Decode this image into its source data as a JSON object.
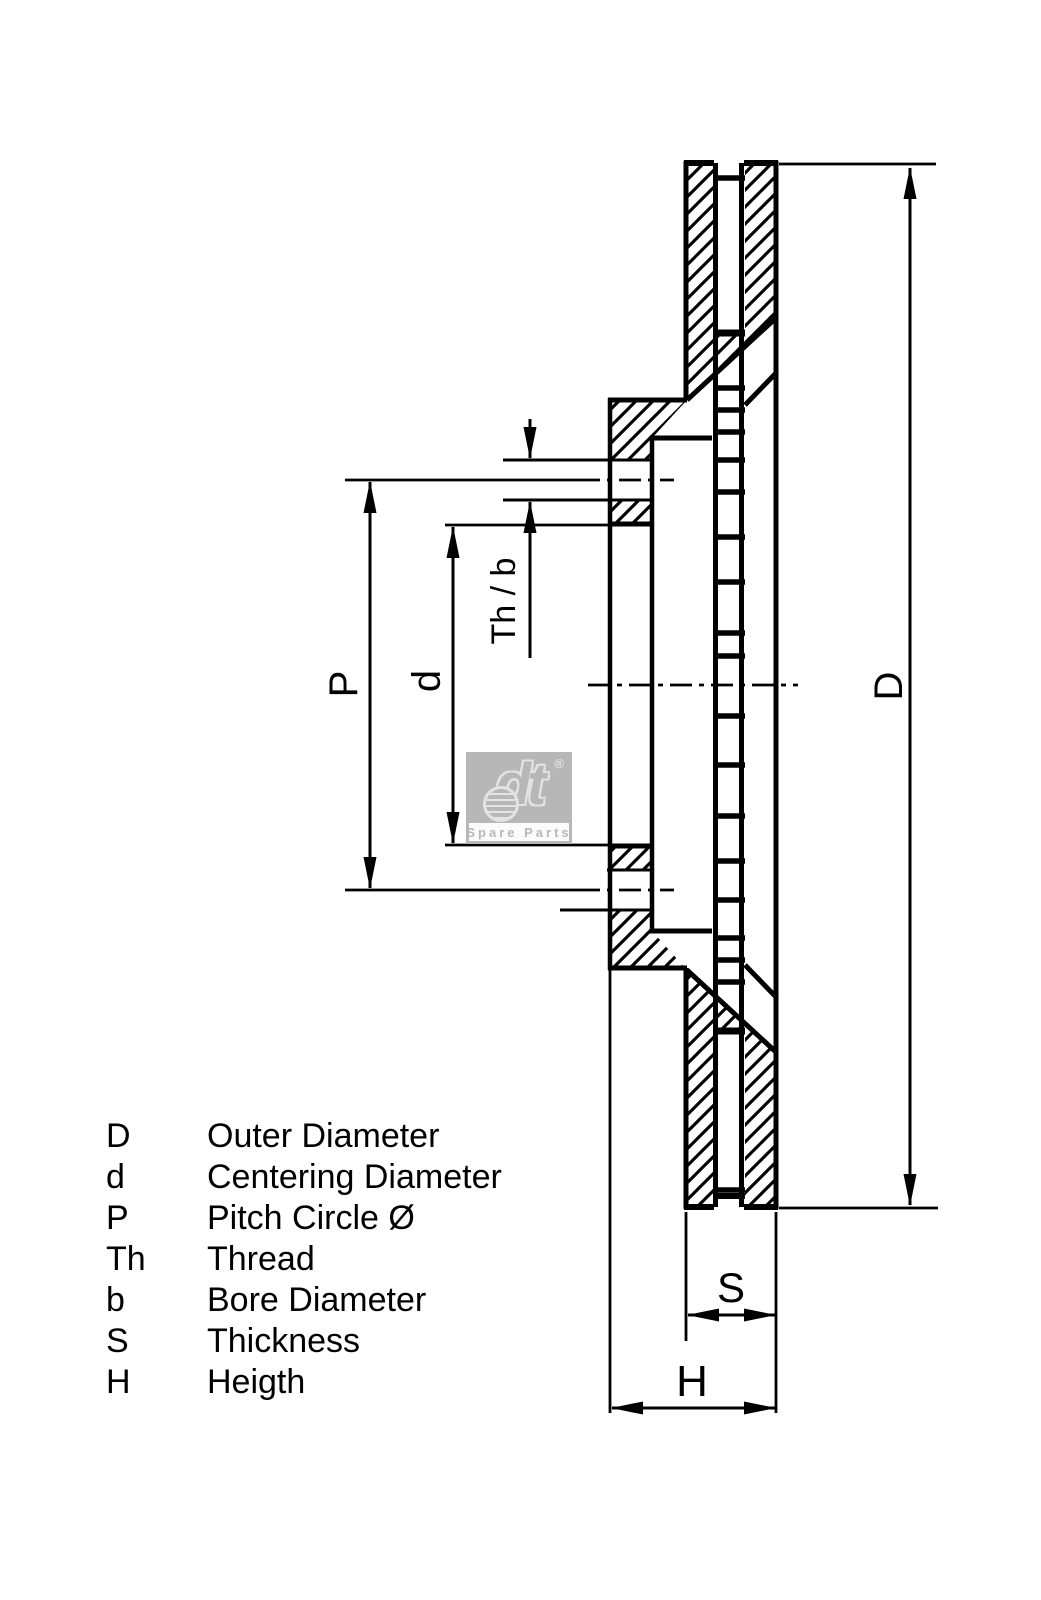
{
  "drawing": {
    "type": "ventilated-brake-disc-cross-section",
    "line_color": "#000000",
    "background_color": "#ffffff"
  },
  "watermark": {
    "brand": "dt",
    "registered": "®",
    "tagline": "Spare Parts",
    "box_color": "#b7b7b7"
  },
  "dimension_labels": {
    "pitch_circle": "P",
    "centering_diameter": "d",
    "thread_bore": "Th / b",
    "outer_diameter": "D",
    "thickness": "S",
    "height": "H"
  },
  "legend": {
    "rows": [
      {
        "symbol": "D",
        "label": "Outer Diameter"
      },
      {
        "symbol": "d",
        "label": "Centering Diameter"
      },
      {
        "symbol": "P",
        "label": "Pitch Circle Ø"
      },
      {
        "symbol": "Th",
        "label": "Thread"
      },
      {
        "symbol": "b",
        "label": "Bore Diameter"
      },
      {
        "symbol": "S",
        "label": "Thickness"
      },
      {
        "symbol": "H",
        "label": "Heigth"
      }
    ]
  }
}
